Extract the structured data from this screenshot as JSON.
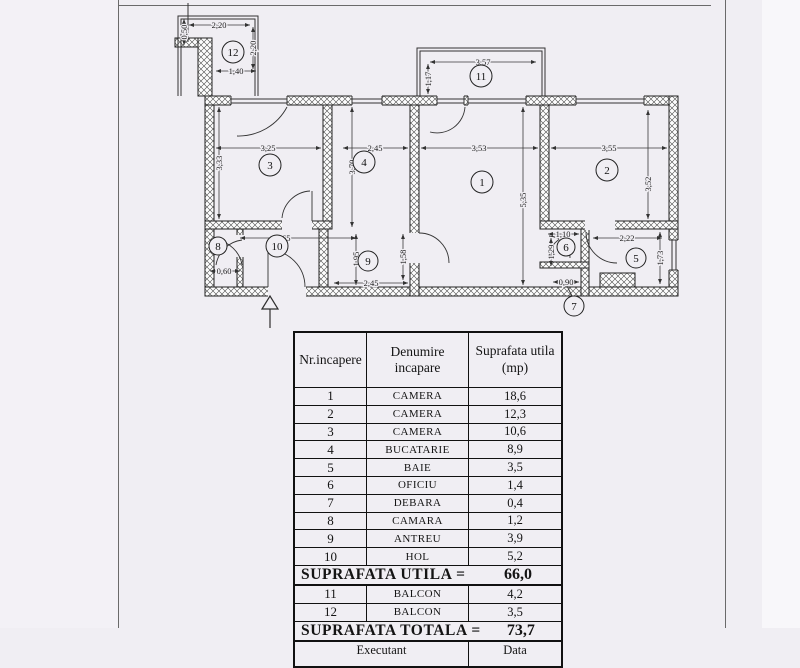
{
  "page": {
    "bg": "#f0eef3",
    "line_color": "#2e2e2e"
  },
  "plan": {
    "rooms": [
      {
        "n": "1",
        "x": 482,
        "y": 182,
        "r": 11
      },
      {
        "n": "2",
        "x": 607,
        "y": 170,
        "r": 11
      },
      {
        "n": "3",
        "x": 270,
        "y": 165,
        "r": 11
      },
      {
        "n": "4",
        "x": 364,
        "y": 162,
        "r": 11
      },
      {
        "n": "5",
        "x": 636,
        "y": 258,
        "r": 10
      },
      {
        "n": "6",
        "x": 566,
        "y": 247,
        "r": 9
      },
      {
        "n": "7",
        "x": 574,
        "y": 306,
        "r": 10
      },
      {
        "n": "8",
        "x": 218,
        "y": 246,
        "r": 9
      },
      {
        "n": "9",
        "x": 368,
        "y": 261,
        "r": 10
      },
      {
        "n": "10",
        "x": 277,
        "y": 246,
        "r": 11
      },
      {
        "n": "11",
        "x": 481,
        "y": 76,
        "r": 11
      },
      {
        "n": "12",
        "x": 233,
        "y": 52,
        "r": 11
      }
    ],
    "dimensions": [
      {
        "label": "2,20",
        "x": 219,
        "y": 25,
        "rot": 0
      },
      {
        "label": "1,40",
        "x": 236,
        "y": 71,
        "rot": 0
      },
      {
        "label": "3,57",
        "x": 483,
        "y": 62,
        "rot": 0
      },
      {
        "label": "3,25",
        "x": 268,
        "y": 148,
        "rot": 0
      },
      {
        "label": "2,45",
        "x": 375,
        "y": 148,
        "rot": 0
      },
      {
        "label": "3,53",
        "x": 479,
        "y": 148,
        "rot": 0
      },
      {
        "label": "3,55",
        "x": 609,
        "y": 148,
        "rot": 0
      },
      {
        "label": "2,65",
        "x": 283,
        "y": 238,
        "rot": 0
      },
      {
        "label": "2,45",
        "x": 371,
        "y": 283,
        "rot": 0
      },
      {
        "label": "0,60",
        "x": 224,
        "y": 271,
        "rot": 0
      },
      {
        "label": "1,10",
        "x": 563,
        "y": 234,
        "rot": 0
      },
      {
        "label": "2,22",
        "x": 627,
        "y": 238,
        "rot": 0
      },
      {
        "label": "0,90",
        "x": 566,
        "y": 282,
        "rot": 0
      },
      {
        "label": "0,50",
        "x": 184,
        "y": 32,
        "rot": 1
      },
      {
        "label": "2,20",
        "x": 253,
        "y": 48,
        "rot": 1
      },
      {
        "label": "1,17",
        "x": 428,
        "y": 79,
        "rot": 1
      },
      {
        "label": "3,33",
        "x": 219,
        "y": 163,
        "rot": 1
      },
      {
        "label": "3,70",
        "x": 352,
        "y": 167,
        "rot": 1
      },
      {
        "label": "5,35",
        "x": 523,
        "y": 200,
        "rot": 1
      },
      {
        "label": "3,52",
        "x": 648,
        "y": 184,
        "rot": 1
      },
      {
        "label": "1,95",
        "x": 356,
        "y": 259,
        "rot": 1
      },
      {
        "label": "1,58",
        "x": 403,
        "y": 257,
        "rot": 1
      },
      {
        "label": "1,29",
        "x": 551,
        "y": 252,
        "rot": 1
      },
      {
        "label": "1,73",
        "x": 660,
        "y": 258,
        "rot": 1
      }
    ]
  },
  "table": {
    "headers": [
      "Nr.incapere",
      "Denumire incapare"
    ],
    "header_col3_line1": "Suprafata utila",
    "header_col3_line2": "(mp)",
    "rows": [
      {
        "nr": "1",
        "name": "CAMERA",
        "area": "18,6"
      },
      {
        "nr": "2",
        "name": "CAMERA",
        "area": "12,3"
      },
      {
        "nr": "3",
        "name": "CAMERA",
        "area": "10,6"
      },
      {
        "nr": "4",
        "name": "BUCATARIE",
        "area": "8,9"
      },
      {
        "nr": "5",
        "name": "BAIE",
        "area": "3,5"
      },
      {
        "nr": "6",
        "name": "OFICIU",
        "area": "1,4"
      },
      {
        "nr": "7",
        "name": "DEBARA",
        "area": "0,4"
      },
      {
        "nr": "8",
        "name": "CAMARA",
        "area": "1,2"
      },
      {
        "nr": "9",
        "name": "ANTREU",
        "area": "3,9"
      },
      {
        "nr": "10",
        "name": "HOL",
        "area": "5,2"
      }
    ],
    "subtotal": {
      "label": "SUPRAFATA UTILA =",
      "value": "66,0"
    },
    "balcony_rows": [
      {
        "nr": "11",
        "name": "BALCON",
        "area": "4,2"
      },
      {
        "nr": "12",
        "name": "BALCON",
        "area": "3,5"
      }
    ],
    "total": {
      "label": "SUPRAFATA TOTALA =",
      "value": "73,7"
    },
    "footer": {
      "executant": "Executant",
      "data": "Data"
    }
  }
}
